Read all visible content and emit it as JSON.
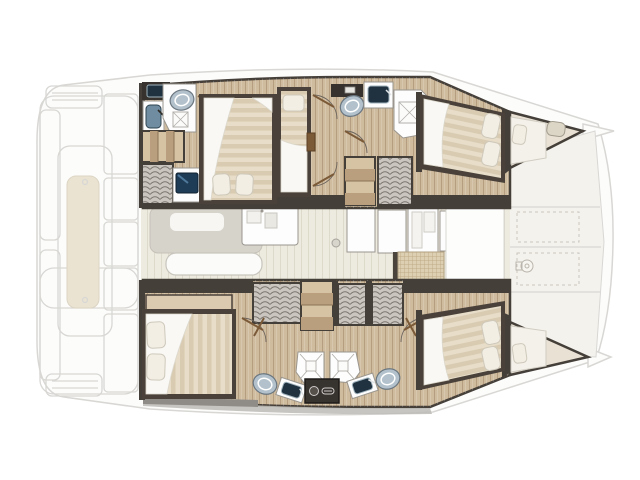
{
  "colors": {
    "hull_wall": "#453f39",
    "floor_wood": "#cfbb9e",
    "floor_wood_light": "#dbcab0",
    "salon_floor": "#edeadf",
    "ghost_line": "#d8d7d4",
    "ghost_fill": "#fcfcfb",
    "ghost_fill2": "#f4f2ec",
    "cockpit_table": "#eae3d2",
    "mattress": "#e7ddc8",
    "mattress_stripe": "#d8cbb2",
    "duvet": "#f9f8f5",
    "pillow": "#f2eee4",
    "pillow_edge": "#cfc9bb",
    "frame_dark": "#4a423a",
    "fixture_white": "#fdfdfd",
    "fixture_line": "#9a968f",
    "toilet": "#b2c1cb",
    "toilet_line": "#6a7680",
    "sink_basin": "#6f8ca0",
    "sink_dark": "#20323f",
    "counter_dark": "#37322d",
    "wardrobe_fill": "#cac6bf",
    "wardrobe_line": "#5f5952",
    "stairs_light": "#d6c3a4",
    "stairs_dark": "#b99f7d",
    "screen": "#1f3c57",
    "screen_hi": "#5b89ad",
    "washer": "#37332f",
    "stove": "#ddd0b2",
    "stove_grid": "#b5a07c",
    "grey_band": "#bdbbb6"
  },
  "floor_plan": {
    "type": "catamaran-yacht-interior-layout",
    "orientation": "bow-right",
    "hulls": 2,
    "exterior": {
      "aft_cockpit": [
        "transom-steps",
        "cockpit-table",
        "bench-seating",
        "side-platforms"
      ],
      "foredeck": [
        "lounge-panels",
        "sun-pads",
        "windlass"
      ],
      "bow_tips": 2
    },
    "salon": [
      "dining-table",
      "bench-seat",
      "galley-counter",
      "sink-unit",
      "cabinet-counters",
      "stove-top",
      "support-pole",
      "forward-door-area"
    ],
    "upper_hull": {
      "aft_bathroom": [
        "vanity-sink",
        "wash-basin",
        "toilet",
        "shower"
      ],
      "aft_cabin": [
        "double-bed",
        "pillows-2",
        "stairs",
        "wardrobe",
        "tv-cabinet"
      ],
      "single_berth": [
        "berth",
        "pillow-1"
      ],
      "mid_bathroom": [
        "toilet",
        "wash-basin",
        "shower",
        "cabinet"
      ],
      "mid": [
        "stairs",
        "wardrobe"
      ],
      "forward_cabin": [
        "double-bed",
        "pillows-2"
      ],
      "bow_berth": [
        "berth-pad",
        "pillow-1",
        "deck-hatch"
      ]
    },
    "lower_hull": {
      "aft_cabin": [
        "double-bed",
        "pillows-2",
        "head-shelf",
        "wardrobe"
      ],
      "mid": [
        "stairs",
        "wardrobes"
      ],
      "bathroom_left": [
        "shower",
        "toilet",
        "wash-basin"
      ],
      "bathroom_right": [
        "shower",
        "toilet",
        "wash-basin"
      ],
      "utility": [
        "washer-cabinet"
      ],
      "forward_cabin": [
        "double-bed",
        "pillows-2"
      ],
      "bow_berth": [
        "berth-pad",
        "pillow-1"
      ]
    }
  }
}
